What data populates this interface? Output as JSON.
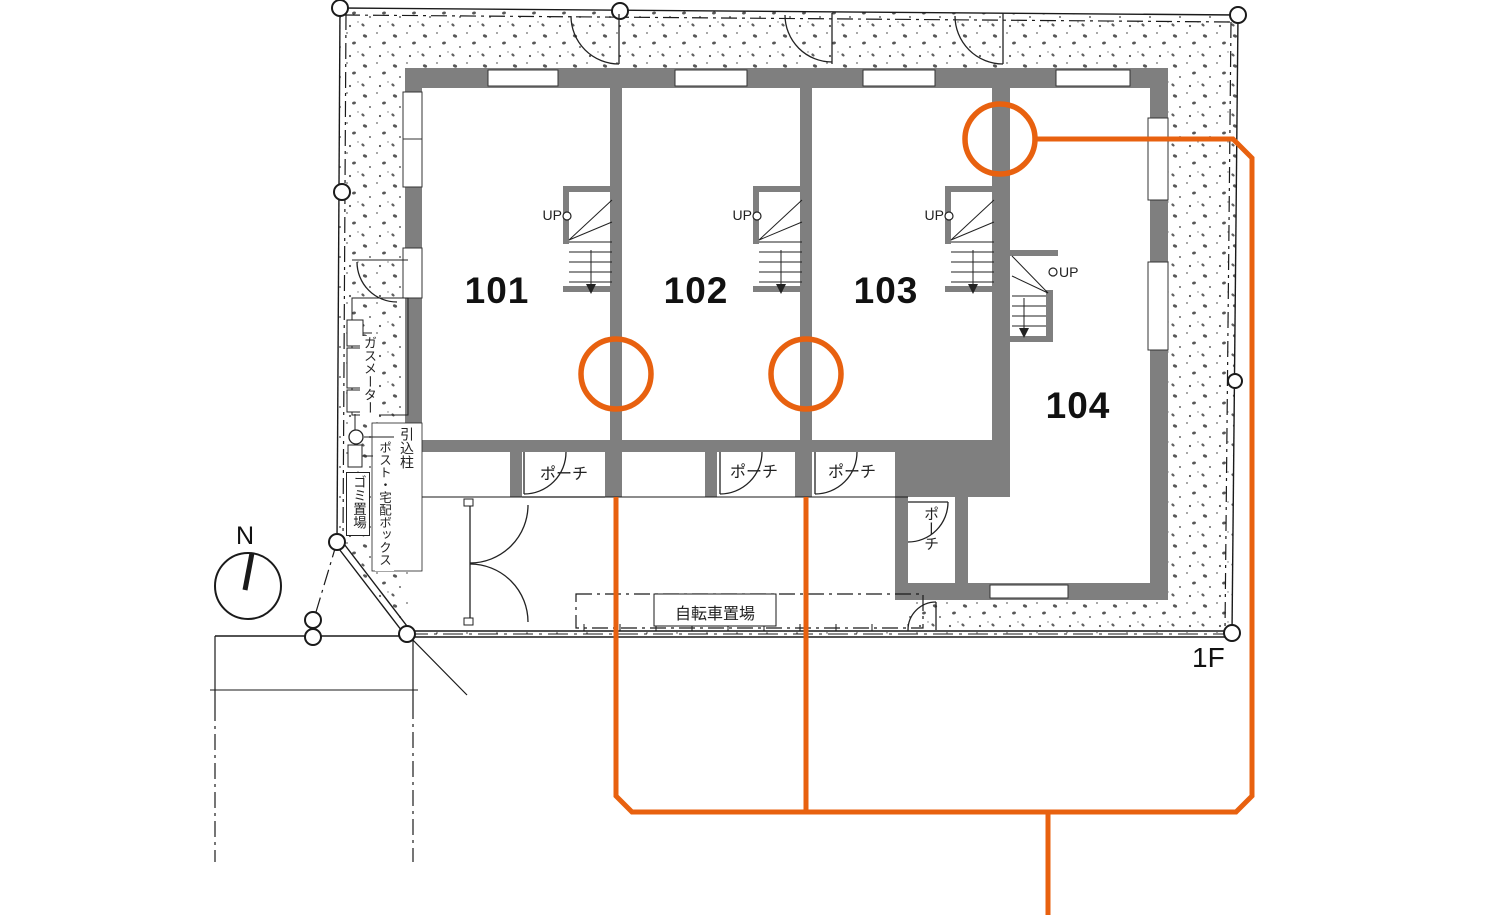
{
  "floor_label": "1F",
  "compass": {
    "north_label": "N"
  },
  "units": [
    {
      "number": "101"
    },
    {
      "number": "102"
    },
    {
      "number": "103"
    },
    {
      "number": "104"
    }
  ],
  "stairs": {
    "up_label": "UP"
  },
  "labels": {
    "porch": "ポーチ",
    "bicycle_parking": "自転車置場",
    "gas_meter": "ガスメーター",
    "service_pole": "引込柱",
    "post_delivery_box": "ポスト・宅配ボックス",
    "garbage_area": "ゴミ置場"
  },
  "colors": {
    "accent_orange": "#E8610F",
    "wall_gray": "#7F7F7F"
  }
}
